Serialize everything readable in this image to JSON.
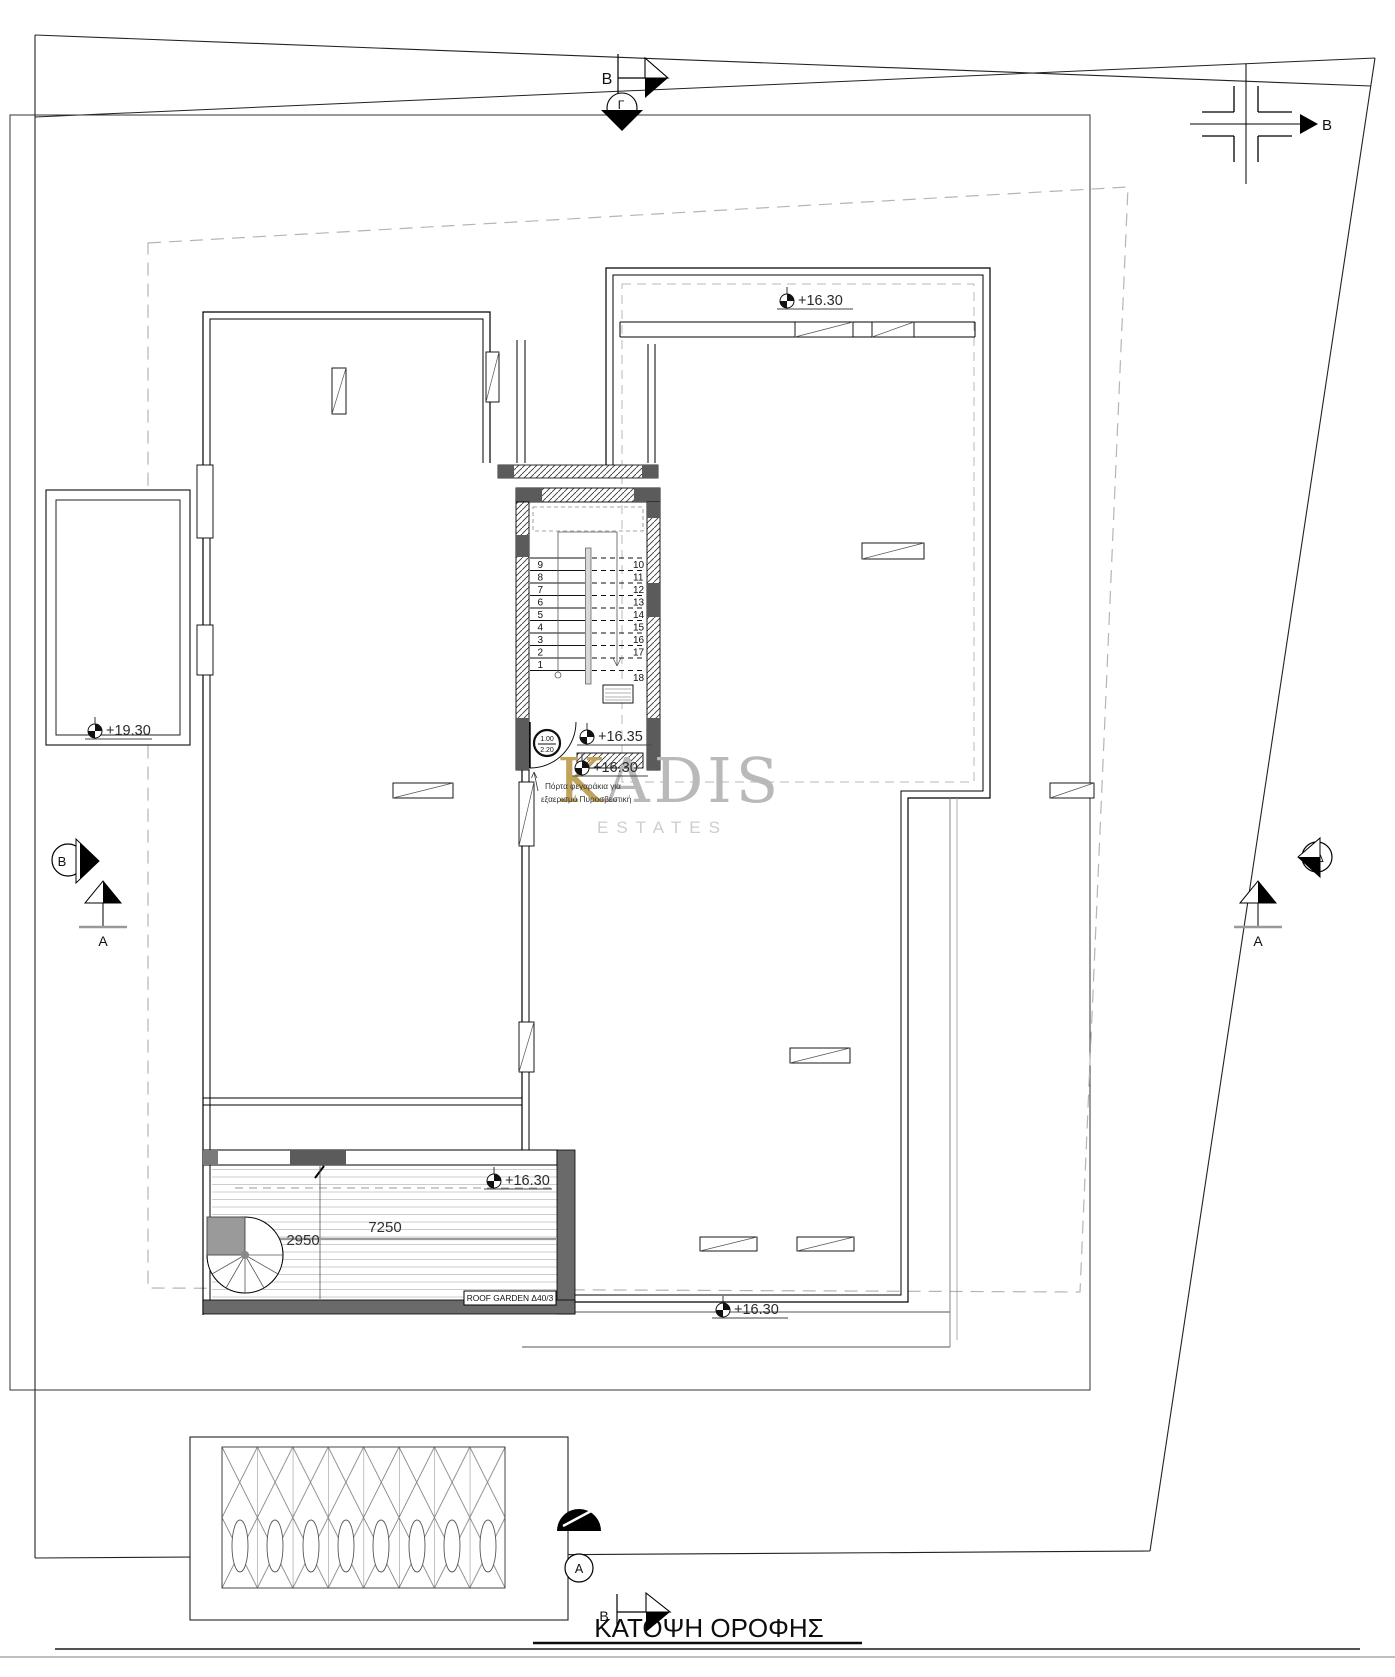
{
  "drawing": {
    "title": "ΚΑΤΟΨΗ ΟΡΟΦΗΣ",
    "watermark": {
      "letter": "K",
      "rest": "ADIS",
      "subtitle": "ESTATES"
    },
    "levels": {
      "planter": "+19.30",
      "roof_top": "+16.30",
      "stair_lobby": "+16.35",
      "below_stairs": "+16.30",
      "roof_garden": "+16.30",
      "lower_terrace": "+16.30"
    },
    "dimensions": {
      "width": "7250",
      "depth": "2950"
    },
    "stair": {
      "left": [
        "9",
        "8",
        "7",
        "6",
        "5",
        "4",
        "3",
        "2",
        "1"
      ],
      "right": [
        "10",
        "11",
        "12",
        "13",
        "14",
        "15",
        "16",
        "17",
        "18"
      ]
    },
    "door": {
      "num": "1.00",
      "den": "2.20"
    },
    "notes": {
      "door_line1": "Πόρτα φεγαράκια για",
      "door_line2": "εξαερισμό Πυροσβεστική"
    },
    "labels": {
      "roof_garden": "ROOF GARDEN Δ40/3"
    },
    "sections": {
      "top_b": "B",
      "top_gamma": "Γ",
      "ne_b": "B",
      "west_b": "B",
      "west_a": "A",
      "east_delta": "Δ",
      "east_a": "A",
      "south_a": "A",
      "south_b": "B"
    },
    "colors": {
      "wall_dark": "#5b5b5b",
      "wall_medium": "#6a6a6a",
      "watermark_gray": "#b9b9b9",
      "watermark_gold": "#c2a35c",
      "dashed_setback": "#b5b5b5"
    }
  }
}
